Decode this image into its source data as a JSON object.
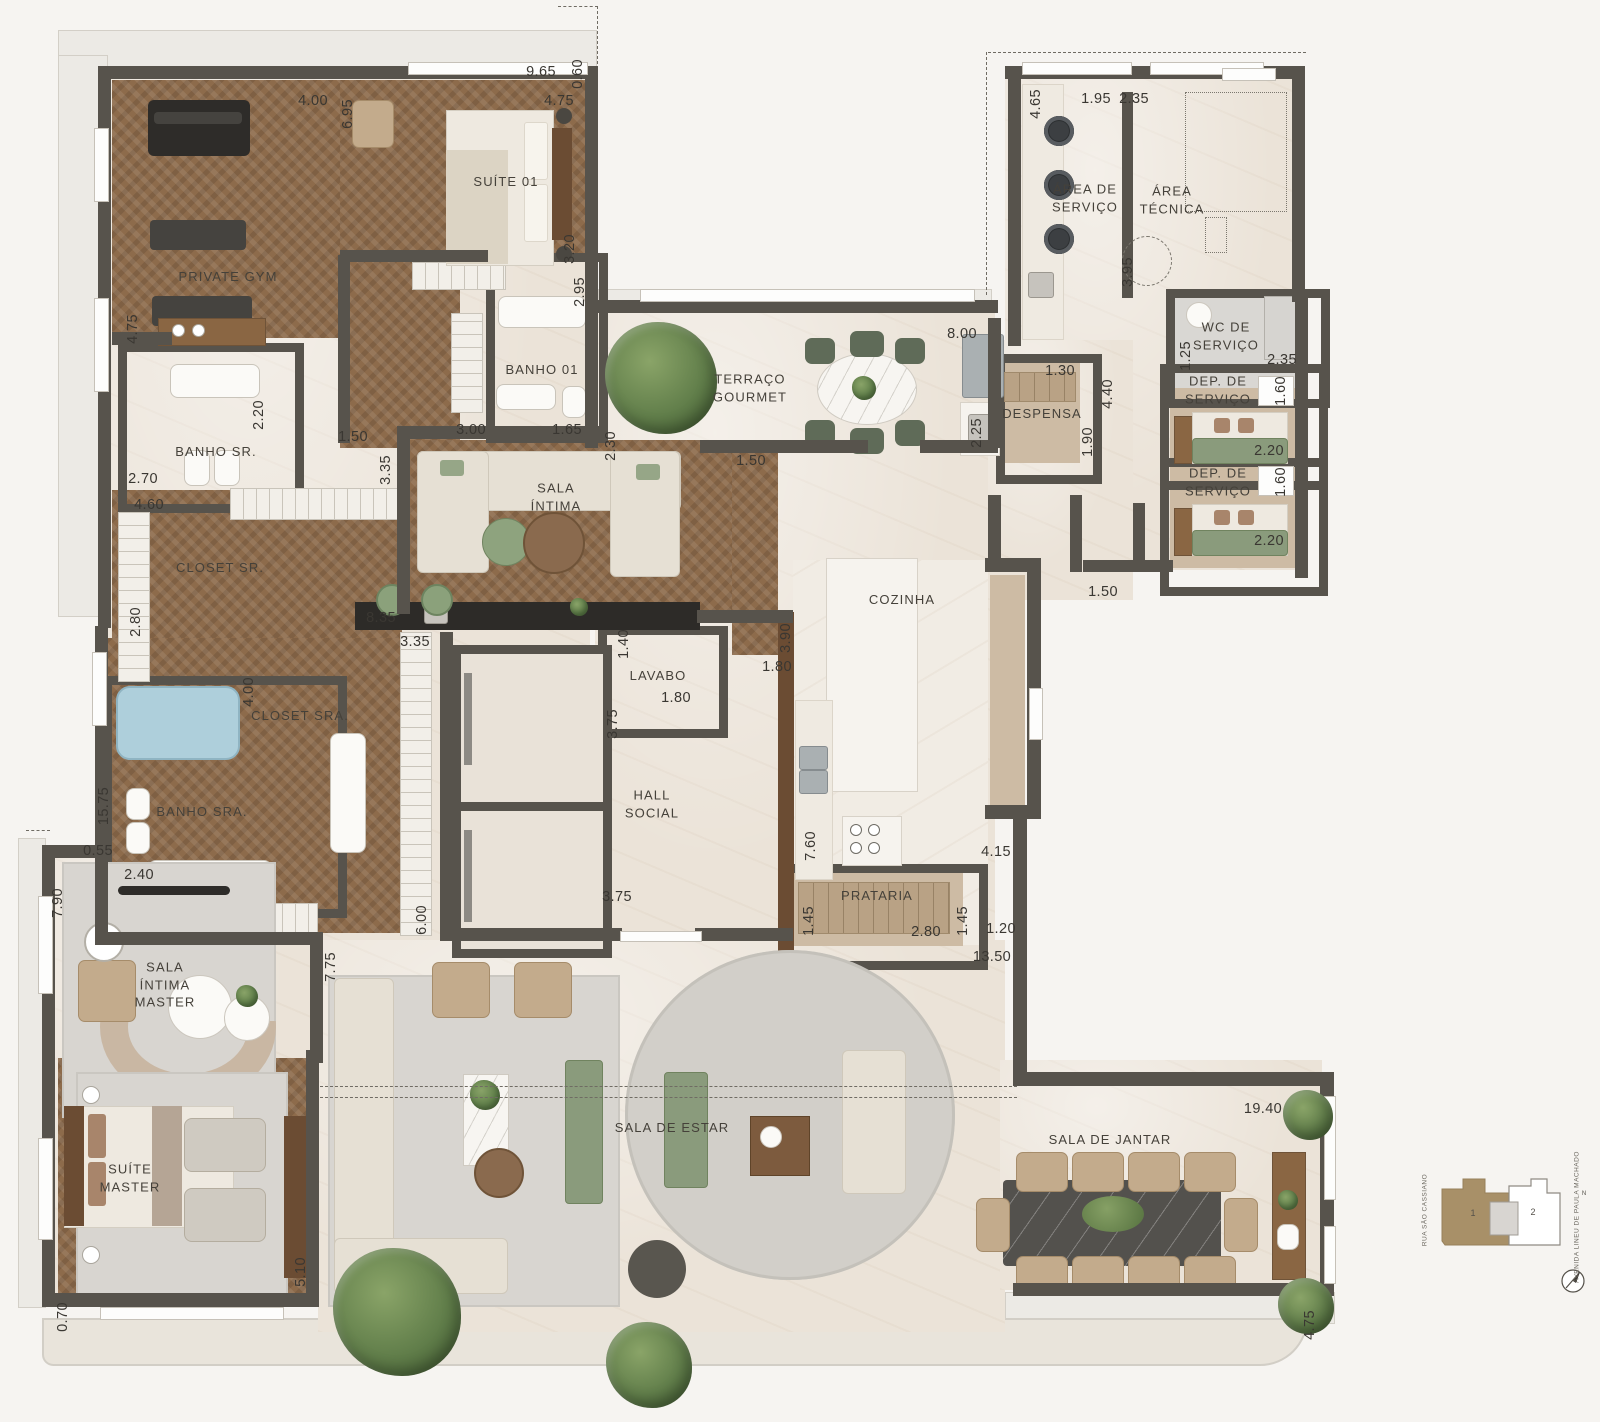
{
  "plan": {
    "rooms": [
      {
        "label": "PRIVATE GYM",
        "x": 228,
        "y": 277
      },
      {
        "label": "SUÍTE 01",
        "x": 506,
        "y": 182
      },
      {
        "label": "BANHO 01",
        "x": 542,
        "y": 370
      },
      {
        "label": "BANHO SR.",
        "x": 216,
        "y": 452
      },
      {
        "label": "CLOSET SR.",
        "x": 220,
        "y": 568
      },
      {
        "label": "CLOSET SRA.",
        "x": 300,
        "y": 716
      },
      {
        "label": "BANHO SRA.",
        "x": 202,
        "y": 812
      },
      {
        "label": "SALA\nÍNTIMA\nMASTER",
        "x": 165,
        "y": 985
      },
      {
        "label": "SUÍTE\nMASTER",
        "x": 130,
        "y": 1178
      },
      {
        "label": "SALA\nÍNTIMA",
        "x": 556,
        "y": 497
      },
      {
        "label": "TERRAÇO\nGOURMET",
        "x": 750,
        "y": 388
      },
      {
        "label": "LAVABO",
        "x": 658,
        "y": 676
      },
      {
        "label": "HALL\nSOCIAL",
        "x": 652,
        "y": 804
      },
      {
        "label": "COZINHA",
        "x": 902,
        "y": 600
      },
      {
        "label": "PRATARIA",
        "x": 877,
        "y": 896
      },
      {
        "label": "DESPENSA",
        "x": 1042,
        "y": 414
      },
      {
        "label": "ÁREA DE\nSERVIÇO",
        "x": 1085,
        "y": 198
      },
      {
        "label": "ÁREA\nTÉCNICA",
        "x": 1172,
        "y": 200
      },
      {
        "label": "WC DE\nSERVIÇO",
        "x": 1226,
        "y": 336
      },
      {
        "label": "DEP. DE\nSERVIÇO",
        "x": 1218,
        "y": 390
      },
      {
        "label": "DEP. DE\nSERVIÇO",
        "x": 1218,
        "y": 482
      },
      {
        "label": "SALA DE ESTAR",
        "x": 672,
        "y": 1128
      },
      {
        "label": "SALA DE JANTAR",
        "x": 1110,
        "y": 1140
      }
    ],
    "dimensions": [
      {
        "t": "9.65",
        "x": 541,
        "y": 72
      },
      {
        "t": "0.60",
        "x": 578,
        "y": 74,
        "v": 1
      },
      {
        "t": "4.00",
        "x": 313,
        "y": 101
      },
      {
        "t": "6.95",
        "x": 348,
        "y": 114,
        "v": 1
      },
      {
        "t": "4.75",
        "x": 559,
        "y": 101
      },
      {
        "t": "3.20",
        "x": 570,
        "y": 249,
        "v": 1
      },
      {
        "t": "2.95",
        "x": 580,
        "y": 292,
        "v": 1
      },
      {
        "t": "4.75",
        "x": 133,
        "y": 329,
        "v": 1
      },
      {
        "t": "2.20",
        "x": 259,
        "y": 415,
        "v": 1
      },
      {
        "t": "3.00",
        "x": 471,
        "y": 430
      },
      {
        "t": "1.65",
        "x": 567,
        "y": 430
      },
      {
        "t": "2.30",
        "x": 611,
        "y": 446,
        "v": 1
      },
      {
        "t": "1.50",
        "x": 353,
        "y": 437
      },
      {
        "t": "2.70",
        "x": 143,
        "y": 479
      },
      {
        "t": "4.60",
        "x": 149,
        "y": 505
      },
      {
        "t": "3.35",
        "x": 386,
        "y": 470,
        "v": 1
      },
      {
        "t": "1.50",
        "x": 751,
        "y": 461
      },
      {
        "t": "8.00",
        "x": 962,
        "y": 334
      },
      {
        "t": "2.25",
        "x": 977,
        "y": 433,
        "v": 1
      },
      {
        "t": "1.30",
        "x": 1060,
        "y": 371
      },
      {
        "t": "4.40",
        "x": 1108,
        "y": 394,
        "v": 1
      },
      {
        "t": "1.90",
        "x": 1088,
        "y": 442,
        "v": 1
      },
      {
        "t": "1.50",
        "x": 1103,
        "y": 592
      },
      {
        "t": "4.65",
        "x": 1036,
        "y": 104,
        "v": 1
      },
      {
        "t": "1.95",
        "x": 1096,
        "y": 99
      },
      {
        "t": "2.35",
        "x": 1134,
        "y": 99
      },
      {
        "t": "3.95",
        "x": 1128,
        "y": 272,
        "v": 1
      },
      {
        "t": "1.25",
        "x": 1186,
        "y": 356,
        "v": 1
      },
      {
        "t": "2.35",
        "x": 1282,
        "y": 360
      },
      {
        "t": "1.60",
        "x": 1281,
        "y": 391,
        "v": 1
      },
      {
        "t": "2.20",
        "x": 1269,
        "y": 451
      },
      {
        "t": "1.60",
        "x": 1281,
        "y": 482,
        "v": 1
      },
      {
        "t": "2.20",
        "x": 1269,
        "y": 541
      },
      {
        "t": "2.80",
        "x": 136,
        "y": 622,
        "v": 1
      },
      {
        "t": "8.35",
        "x": 381,
        "y": 618
      },
      {
        "t": "3.35",
        "x": 415,
        "y": 642
      },
      {
        "t": "1.40",
        "x": 624,
        "y": 644,
        "v": 1
      },
      {
        "t": "1.80",
        "x": 676,
        "y": 698
      },
      {
        "t": "1.80",
        "x": 777,
        "y": 667
      },
      {
        "t": "3.90",
        "x": 786,
        "y": 638,
        "v": 1
      },
      {
        "t": "3.75",
        "x": 613,
        "y": 724,
        "v": 1
      },
      {
        "t": "3.75",
        "x": 617,
        "y": 897
      },
      {
        "t": "6.00",
        "x": 422,
        "y": 920,
        "v": 1
      },
      {
        "t": "4.00",
        "x": 249,
        "y": 692,
        "v": 1
      },
      {
        "t": "15.75",
        "x": 104,
        "y": 806,
        "v": 1
      },
      {
        "t": "0.55",
        "x": 98,
        "y": 851
      },
      {
        "t": "2.40",
        "x": 139,
        "y": 875
      },
      {
        "t": "7.90",
        "x": 58,
        "y": 903,
        "v": 1
      },
      {
        "t": "7.60",
        "x": 811,
        "y": 846,
        "v": 1
      },
      {
        "t": "4.15",
        "x": 996,
        "y": 852
      },
      {
        "t": "1.45",
        "x": 809,
        "y": 921,
        "v": 1
      },
      {
        "t": "2.80",
        "x": 926,
        "y": 932
      },
      {
        "t": "1.45",
        "x": 963,
        "y": 921,
        "v": 1
      },
      {
        "t": "1.20",
        "x": 1001,
        "y": 929
      },
      {
        "t": "13.50",
        "x": 992,
        "y": 957
      },
      {
        "t": "7.75",
        "x": 331,
        "y": 967,
        "v": 1
      },
      {
        "t": "5.10",
        "x": 301,
        "y": 1272,
        "v": 1
      },
      {
        "t": "0.70",
        "x": 63,
        "y": 1317,
        "v": 1
      },
      {
        "t": "19.40",
        "x": 1263,
        "y": 1109
      },
      {
        "t": "4.75",
        "x": 1310,
        "y": 1325,
        "v": 1
      }
    ]
  },
  "site_key": {
    "unit_1_label": "1",
    "unit_2_label": "2",
    "street_left": "RUA SÃO CASSIANO",
    "street_right": "AVENIDA LINEU DE PAULA MACHADO",
    "north_label": "N"
  }
}
